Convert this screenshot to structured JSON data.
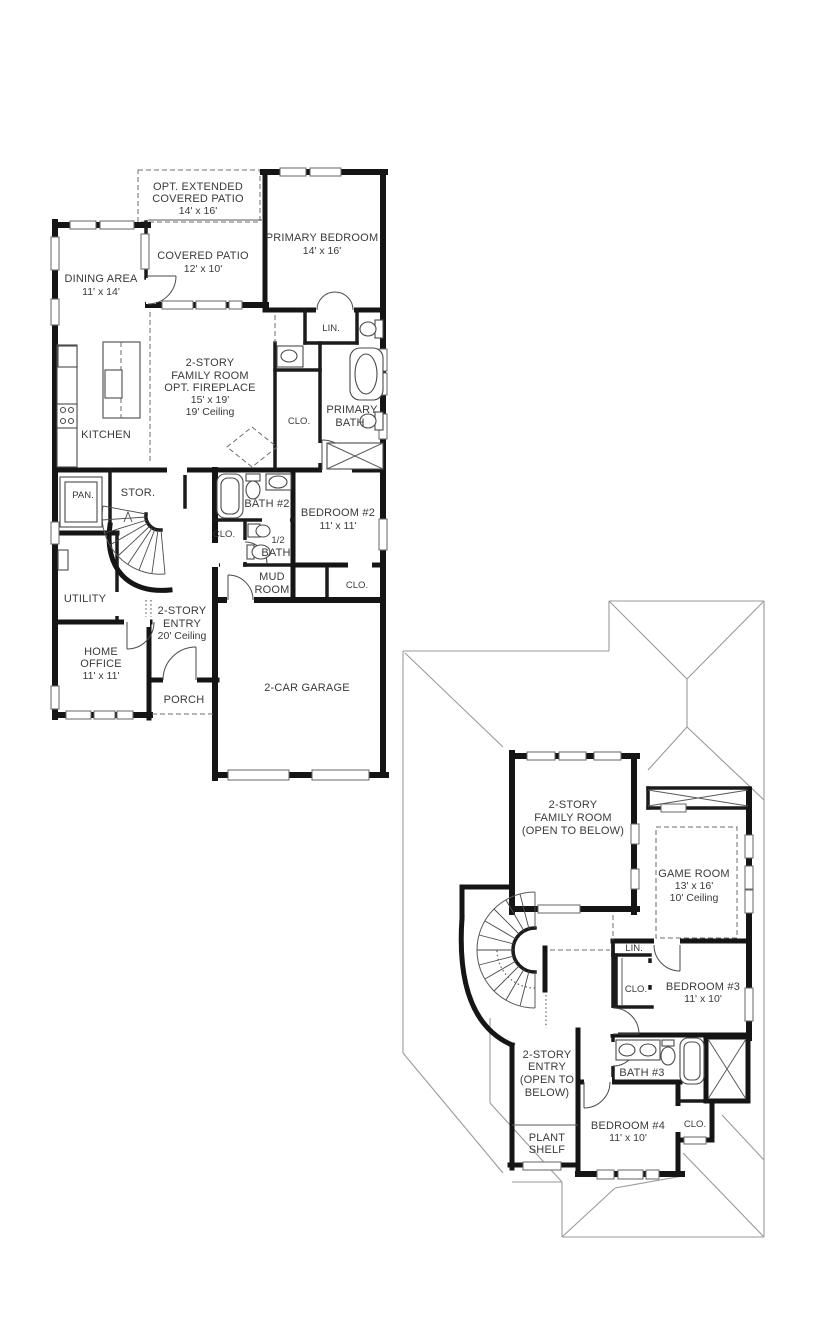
{
  "meta": {
    "drawing_type": "two-story residential floor plan",
    "background_color": "#ffffff",
    "wall_color": "#151515",
    "roof_line_color": "#9a9a9a",
    "text_color": "#3a3a3a"
  },
  "floor1": {
    "rooms": [
      {
        "id": "opt-extended-covered-patio",
        "lines": [
          "OPT. EXTENDED",
          "COVERED PATIO",
          "14' x 16'"
        ]
      },
      {
        "id": "covered-patio",
        "lines": [
          "COVERED PATIO",
          "12' x 10'"
        ]
      },
      {
        "id": "primary-bedroom",
        "lines": [
          "PRIMARY BEDROOM",
          "14' x 16'"
        ]
      },
      {
        "id": "dining-area",
        "lines": [
          "DINING AREA",
          "11' x 14'"
        ]
      },
      {
        "id": "family-room",
        "lines": [
          "2-STORY",
          "FAMILY ROOM",
          "OPT. FIREPLACE",
          "15' x 19'",
          "19' Ceiling"
        ]
      },
      {
        "id": "linen",
        "lines": [
          "LIN."
        ]
      },
      {
        "id": "kitchen",
        "lines": [
          "KITCHEN"
        ]
      },
      {
        "id": "primary-bath",
        "lines": [
          "PRIMARY",
          "BATH"
        ]
      },
      {
        "id": "primary-closet",
        "lines": [
          "CLO."
        ]
      },
      {
        "id": "pantry",
        "lines": [
          "PAN."
        ]
      },
      {
        "id": "storage",
        "lines": [
          "STOR."
        ]
      },
      {
        "id": "bath-2",
        "lines": [
          "BATH #2"
        ]
      },
      {
        "id": "bedroom-2",
        "lines": [
          "BEDROOM #2",
          "11' x 11'"
        ]
      },
      {
        "id": "hall-closet",
        "lines": [
          "CLO."
        ]
      },
      {
        "id": "half-bath",
        "lines": [
          "1/2",
          "BATH"
        ]
      },
      {
        "id": "mud-room",
        "lines": [
          "MUD",
          "ROOM"
        ]
      },
      {
        "id": "bedroom2-closet",
        "lines": [
          "CLO."
        ]
      },
      {
        "id": "utility",
        "lines": [
          "UTILITY"
        ]
      },
      {
        "id": "entry",
        "lines": [
          "2-STORY",
          "ENTRY",
          "20' Ceiling"
        ]
      },
      {
        "id": "home-office",
        "lines": [
          "HOME",
          "OFFICE",
          "11' x 11'"
        ]
      },
      {
        "id": "porch",
        "lines": [
          "PORCH"
        ]
      },
      {
        "id": "garage",
        "lines": [
          "2-CAR GARAGE"
        ]
      }
    ]
  },
  "floor2": {
    "rooms": [
      {
        "id": "family-room-open-to-below",
        "lines": [
          "2-STORY",
          "FAMILY ROOM",
          "(OPEN TO BELOW)"
        ]
      },
      {
        "id": "game-room",
        "lines": [
          "GAME ROOM",
          "13' x 16'",
          "10' Ceiling"
        ]
      },
      {
        "id": "linen-2",
        "lines": [
          "LIN."
        ]
      },
      {
        "id": "bedroom3-closet",
        "lines": [
          "CLO."
        ]
      },
      {
        "id": "bedroom-3",
        "lines": [
          "BEDROOM #3",
          "11' x 10'"
        ]
      },
      {
        "id": "bath-3",
        "lines": [
          "BATH #3"
        ]
      },
      {
        "id": "entry-open-to-below",
        "lines": [
          "2-STORY",
          "ENTRY",
          "(OPEN TO",
          "BELOW)"
        ]
      },
      {
        "id": "bedroom-4",
        "lines": [
          "BEDROOM #4",
          "11' x 10'"
        ]
      },
      {
        "id": "bedroom4-closet",
        "lines": [
          "CLO."
        ]
      },
      {
        "id": "plant-shelf",
        "lines": [
          "PLANT",
          "SHELF"
        ]
      }
    ]
  }
}
